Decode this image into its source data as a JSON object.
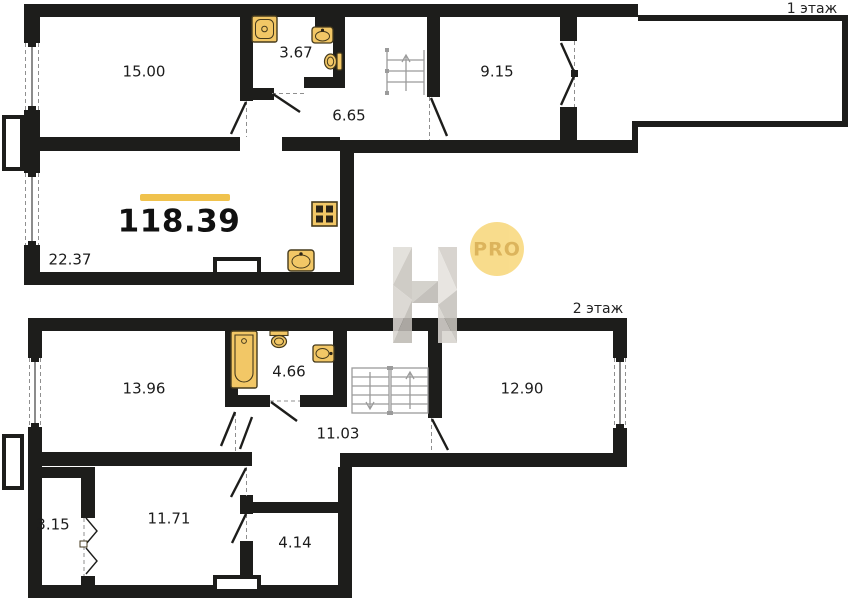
{
  "plan": {
    "type": "duplex-apartment-floor-plan",
    "total_area": "118.39"
  },
  "floor1": {
    "label": "1 этаж",
    "rooms": [
      {
        "id": "room-15-00",
        "area": "15.00"
      },
      {
        "id": "bathroom-3-67",
        "area": "3.67"
      },
      {
        "id": "hallway-6-65",
        "area": "6.65"
      },
      {
        "id": "room-9-15",
        "area": "9.15"
      },
      {
        "id": "kitchen-living-22-37",
        "area": "22.37"
      }
    ],
    "icons": [
      "shower-tray-icon",
      "washbasin-icon",
      "toilet-icon",
      "staircase-up-icon",
      "stove-icon",
      "kitchen-sink-icon"
    ]
  },
  "floor2": {
    "label": "2 этаж",
    "rooms": [
      {
        "id": "room-13-96",
        "area": "13.96"
      },
      {
        "id": "bathroom-4-66",
        "area": "4.66"
      },
      {
        "id": "hallway-11-03",
        "area": "11.03"
      },
      {
        "id": "room-12-90",
        "area": "12.90"
      },
      {
        "id": "wardrobe-3-15",
        "area": "3.15"
      },
      {
        "id": "room-11-71",
        "area": "11.71"
      },
      {
        "id": "room-4-14",
        "area": "4.14"
      }
    ],
    "icons": [
      "bathtub-icon",
      "toilet-icon",
      "washbasin-icon",
      "staircase-up-down-icon",
      "accordion-door-icon"
    ]
  },
  "watermark": {
    "letter": "Н",
    "badge": "PRO"
  },
  "colors": {
    "wall": "#1d1d1b",
    "accent_yellow": "#f0c24d",
    "fixture_fill": "#f2c766",
    "fixture_stroke": "#453a1c",
    "stair_gray": "#9b9b9b",
    "dash_gray": "#8f8f8f",
    "pro_badge_fill": "#f8d87d",
    "pro_badge_text": "#dcb45c"
  }
}
